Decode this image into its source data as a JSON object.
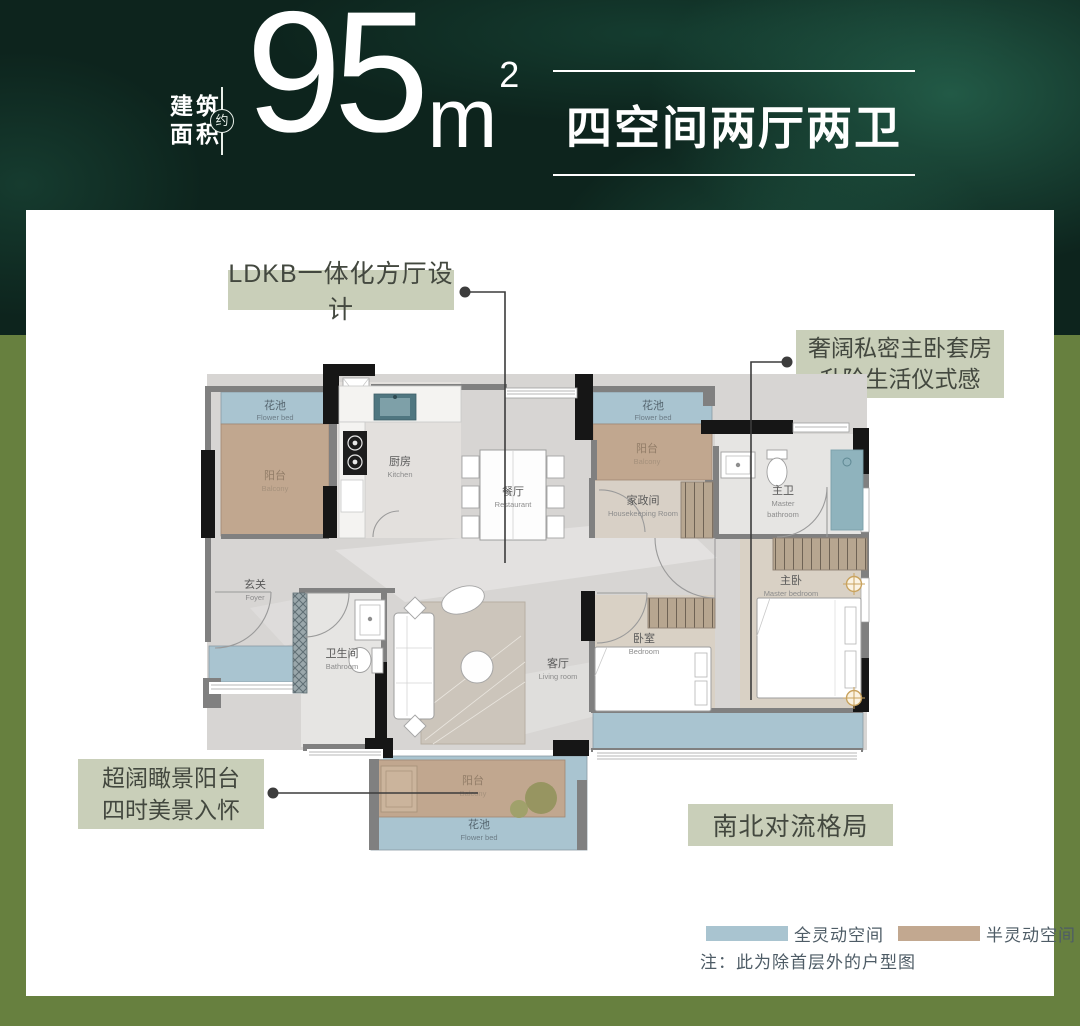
{
  "header": {
    "area_label_line1": "建筑",
    "area_label_line2": "面积",
    "approx_badge": "约",
    "area_value": "95",
    "area_unit": "m",
    "area_exponent": "2",
    "layout_title": "四空间两厅两卫"
  },
  "callouts": {
    "ldkb": "LDKB一体化方厅设计",
    "master_suite_line1": "奢阔私密主卧套房",
    "master_suite_line2": "升阶生活仪式感",
    "view_balcony_line1": "超阔瞰景阳台",
    "view_balcony_line2": "四时美景入怀",
    "airflow": "南北对流格局"
  },
  "legend": {
    "full_flex_label": "全灵动空间",
    "full_flex_color": "#a9c4d0",
    "semi_flex_label": "半灵动空间",
    "semi_flex_color": "#c2a890",
    "note": "注：此为除首层外的户型图"
  },
  "rooms": {
    "flower_bed_top_left": {
      "zh": "花池",
      "en": "Flower bed"
    },
    "balcony_top_left": {
      "zh": "阳台",
      "en": "Balcony"
    },
    "kitchen": {
      "zh": "厨房",
      "en": "Kitchen"
    },
    "dining": {
      "zh": "餐厅",
      "en": "Restaurant"
    },
    "flower_bed_top_right": {
      "zh": "花池",
      "en": "Flower bed"
    },
    "balcony_top_right": {
      "zh": "阳台",
      "en": "Balcony"
    },
    "housekeeping": {
      "zh": "家政间",
      "en": "Housekeeping Room"
    },
    "master_bathroom": {
      "zh": "主卫",
      "en_line1": "Master",
      "en_line2": "bathroom"
    },
    "master_bedroom": {
      "zh": "主卧",
      "en": "Master bedroom"
    },
    "foyer": {
      "zh": "玄关",
      "en": "Foyer"
    },
    "bathroom": {
      "zh": "卫生间",
      "en": "Bathroom"
    },
    "living_room": {
      "zh": "客厅",
      "en": "Living room"
    },
    "bedroom": {
      "zh": "卧室",
      "en": "Bedroom"
    },
    "balcony_bottom": {
      "zh": "阳台",
      "en": "Balcony"
    },
    "flower_bed_bottom": {
      "zh": "花池",
      "en": "Flower bed"
    }
  },
  "colors": {
    "header_dark_green": "#0d241d",
    "frame_olive": "#67803f",
    "card_white": "#ffffff",
    "tag_sage": "#c9cfb9",
    "zone_blue": "#a9c4d0",
    "zone_tan": "#c1a78f",
    "wall_black": "#161616",
    "wall_gray": "#808080",
    "marble_floor": "#d7d5d3",
    "sink_teal": "#4f7680",
    "gold_light": "#c9a35f"
  }
}
